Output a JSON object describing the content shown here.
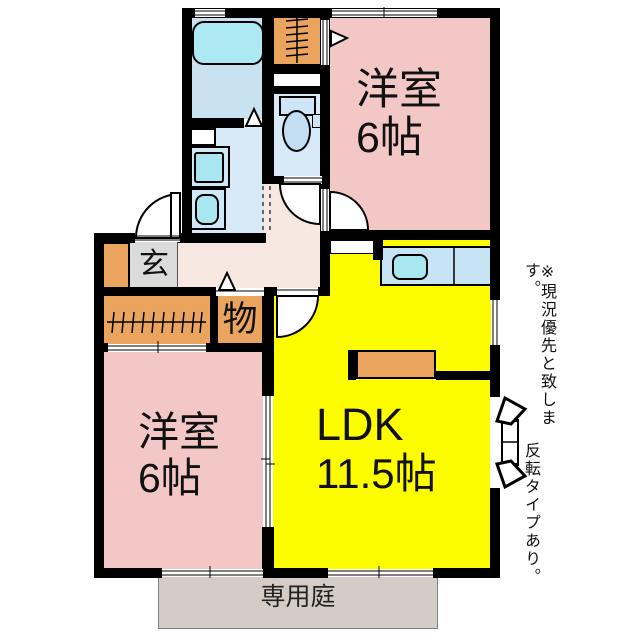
{
  "plan": {
    "rooms": {
      "bedroom_top": {
        "name": "洋室",
        "size": "6帖"
      },
      "bedroom_bottom": {
        "name": "洋室",
        "size": "6帖"
      },
      "ldk": {
        "name": "LDK",
        "size": "11.5帖"
      },
      "genkan": {
        "label": "玄"
      },
      "storage": {
        "label": "物"
      },
      "garden": {
        "label": "専用庭"
      }
    },
    "notes": {
      "line1": "※現況優先と致します。",
      "line2": "反転タイプあり。"
    },
    "colors": {
      "wall": "#000000",
      "bedroom": "#F2C7C5",
      "ldk": "#FDFD00",
      "closet_orange": "#EBA45E",
      "bath_floor": "#C9E2F2",
      "wet_floor": "#D8EAF8",
      "fixture_cyan": "#A9E7F0",
      "counter_blue": "#C7E4F4",
      "hallway": "#F7E9E1",
      "genkan_tile": "#DBDBDB",
      "garden": "#D5CCC5"
    }
  }
}
